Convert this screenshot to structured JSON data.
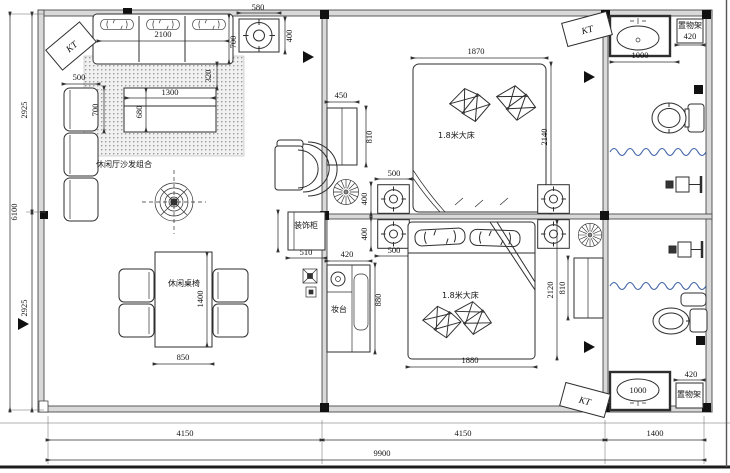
{
  "drawing": {
    "type": "architectural-floor-plan",
    "colors": {
      "line": "#2e2e2e",
      "wall_fill": "#d9d9d9",
      "curtain_wave": "#3b5fa8",
      "column": "#111111"
    },
    "labels": {
      "kt_top_left": "KT",
      "kt_top_right": "KT",
      "kt_bottom_right": "KT",
      "living_sofa_group": "休闲厅沙发组合",
      "dining_set": "休闲桌椅",
      "bed1": "1.8米大床",
      "bed2": "1.8米大床",
      "deco_cabinet": "装饰柜",
      "dresser": "妆台",
      "shelf_top": "置物架",
      "shelf_bottom": "置物架"
    },
    "dimensions": {
      "sofa_width": "2100",
      "sofa_depth": "700",
      "sofa_side_gap": "320",
      "corner_seat_width": "500",
      "corner_seat_depth": "700",
      "coffee_table_width": "1300",
      "coffee_table_depth": "680",
      "ceiling_box_width": "580",
      "ceiling_box_height": "400",
      "left_upper": "2925",
      "left_total": "6100",
      "left_lower": "2925",
      "dining_width": "850",
      "dining_length": "1400",
      "radiator1_width": "450",
      "radiator1_height": "810",
      "bed1_width": "1870",
      "bed1_length": "2140",
      "spk_upper_width": "500",
      "spk_upper_height": "400",
      "spk_lower_width": "500",
      "spk_lower_height": "400",
      "cabinet_width": "510",
      "dresser_width": "420",
      "dresser_height": "880",
      "bed2_width": "1880",
      "room2_height": "2120",
      "radiator2_height": "810",
      "sink_top_width": "1000",
      "shelf_top_width": "420",
      "sink_bottom_width": "1000",
      "shelf_bottom_width": "420",
      "bottom_seg1": "4150",
      "bottom_seg2": "4150",
      "bottom_seg3": "1400",
      "bottom_total": "9900"
    }
  }
}
